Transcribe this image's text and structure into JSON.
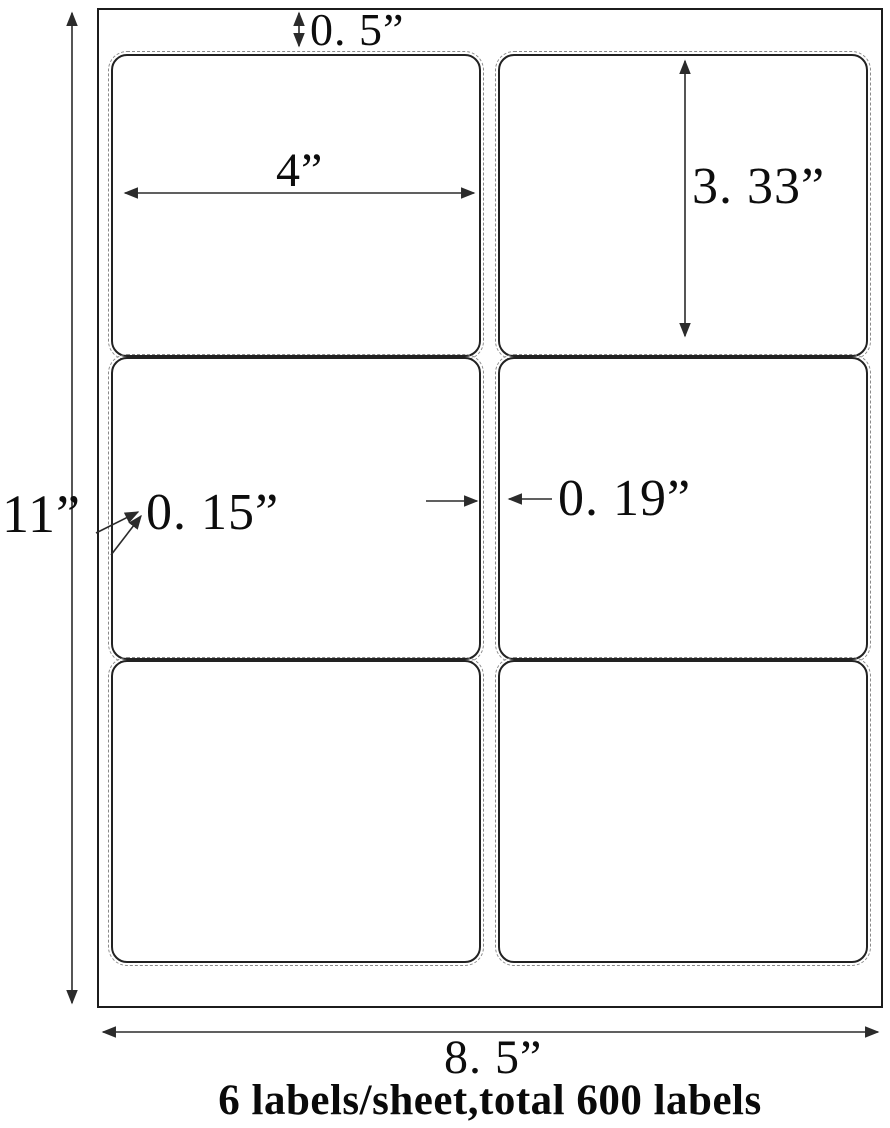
{
  "diagram": {
    "type": "label-sheet-template",
    "caption": "6 labels/sheet,total 600 labels",
    "labels_per_sheet": 6,
    "total_labels": 600,
    "grid": {
      "rows": 3,
      "columns": 2
    }
  },
  "dims": {
    "top_margin": "0. 5”",
    "label_width": "4”",
    "label_height": "3. 33”",
    "side_margin": "0. 15”",
    "column_gap": "0. 19”",
    "sheet_height": "11”",
    "sheet_width": "8. 5”"
  },
  "colors": {
    "background": "#ffffff",
    "sheet_border": "#1c1c1c",
    "label_border": "#222222",
    "perforation_dash": "#8a8a8a",
    "arrow": "#2b2b2b",
    "text": "#0d0d0d"
  }
}
